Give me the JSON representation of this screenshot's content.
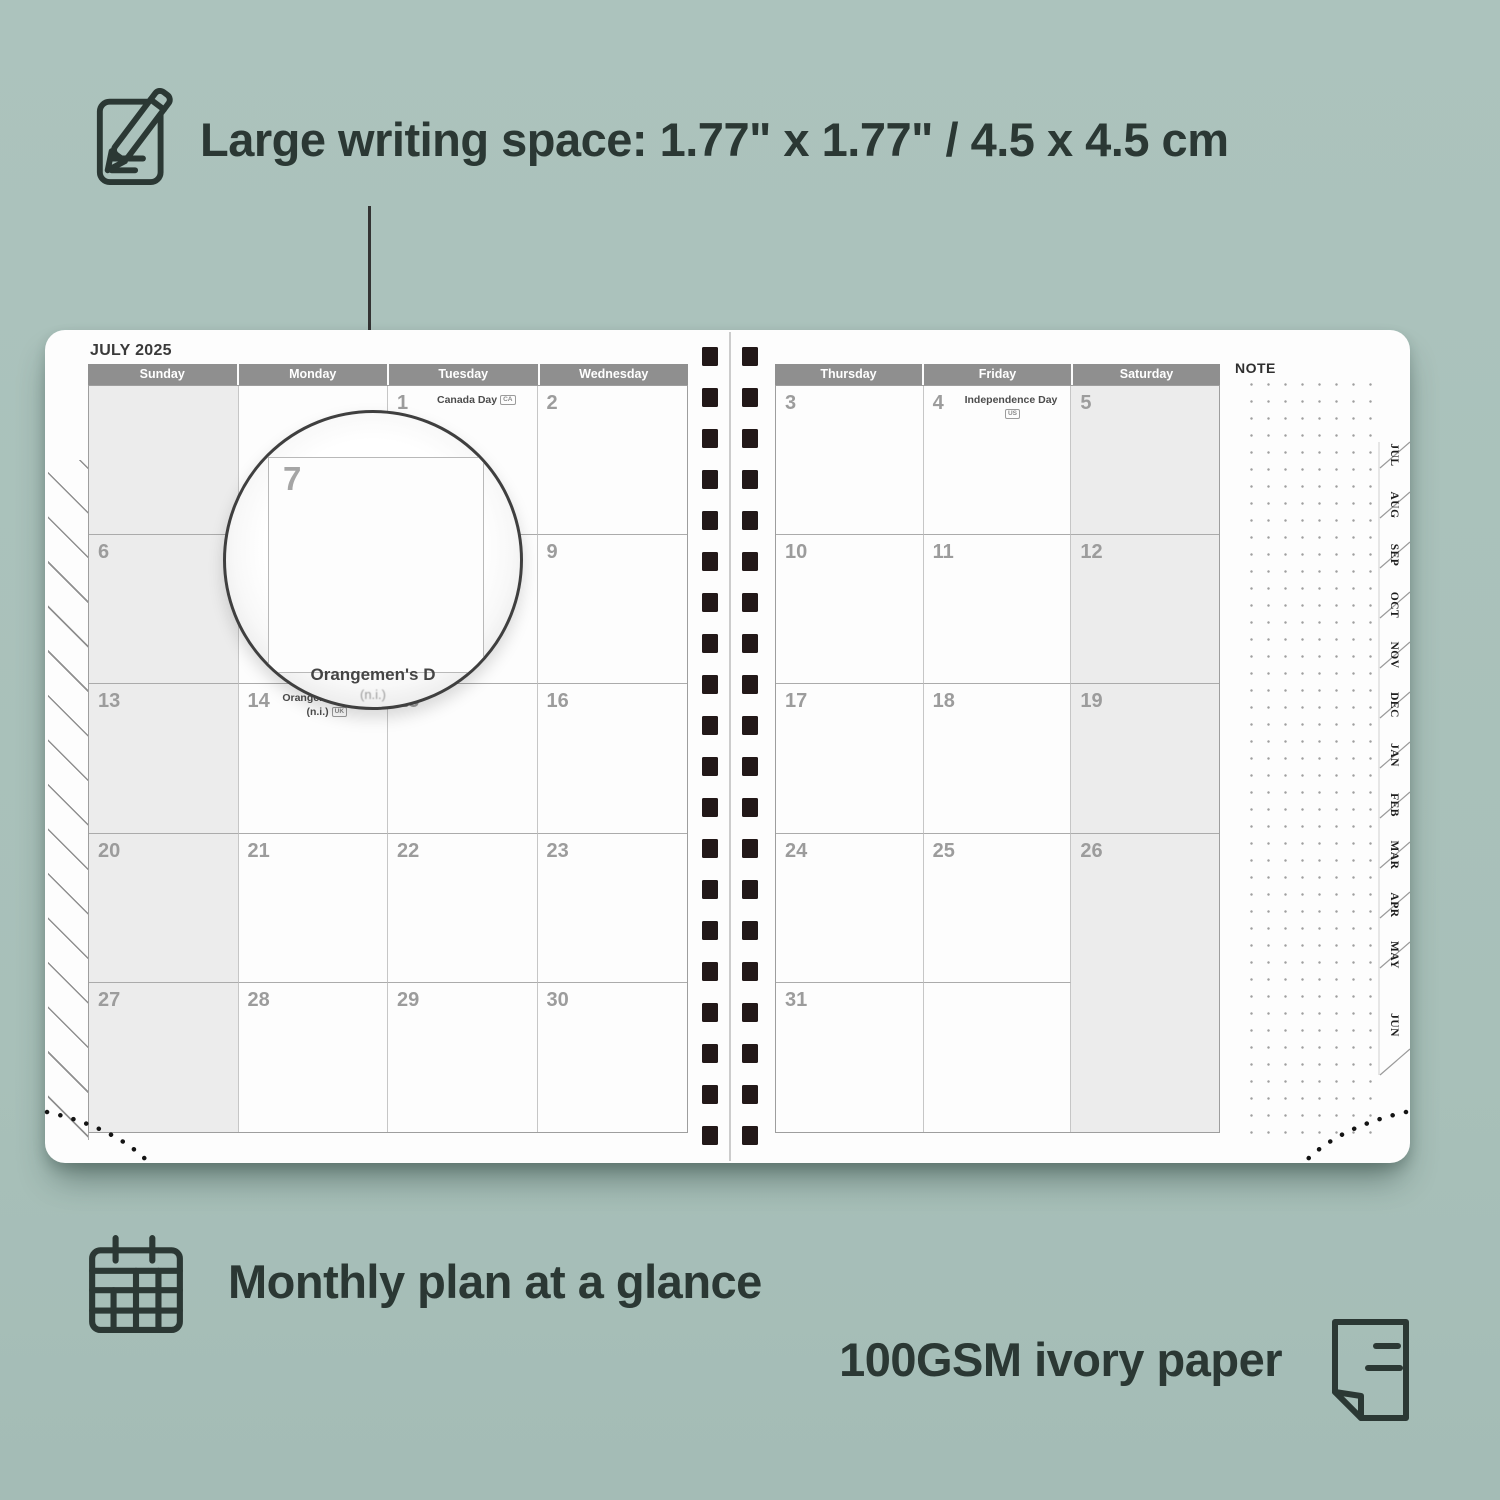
{
  "annotations": {
    "top": {
      "icon": "note-pencil-icon",
      "text": "Large writing space: 1.77\" x 1.77\" / 4.5 x 4.5 cm"
    },
    "bottom_left": {
      "icon": "calendar-grid-icon",
      "text": "Monthly plan at a glance"
    },
    "bottom_right": {
      "icon": "paper-sheet-icon",
      "text": "100GSM ivory paper"
    }
  },
  "planner": {
    "month_title": "JULY 2025",
    "note_label": "NOTE",
    "left_page": {
      "day_headers": [
        "Sunday",
        "Monday",
        "Tuesday",
        "Wednesday"
      ],
      "weekend_col": 0,
      "rows": [
        [
          {
            "date": ""
          },
          {
            "date": ""
          },
          {
            "date": "1",
            "holiday": "Canada Day",
            "badge": "CA"
          },
          {
            "date": "2"
          }
        ],
        [
          {
            "date": "6"
          },
          {
            "date": "7"
          },
          {
            "date": "8"
          },
          {
            "date": "9"
          }
        ],
        [
          {
            "date": "13"
          },
          {
            "date": "14",
            "holiday": "Orangemen's Day",
            "holiday2": "(n.i.)",
            "badge": "UK"
          },
          {
            "date": "15"
          },
          {
            "date": "16"
          }
        ],
        [
          {
            "date": "20"
          },
          {
            "date": "21"
          },
          {
            "date": "22"
          },
          {
            "date": "23"
          }
        ],
        [
          {
            "date": "27"
          },
          {
            "date": "28"
          },
          {
            "date": "29"
          },
          {
            "date": "30"
          }
        ]
      ]
    },
    "right_page": {
      "day_headers": [
        "Thursday",
        "Friday",
        "Saturday"
      ],
      "weekend_col": 2,
      "rows": [
        [
          {
            "date": "3"
          },
          {
            "date": "4",
            "holiday": "Independence Day",
            "badge": "US"
          },
          {
            "date": "5"
          }
        ],
        [
          {
            "date": "10"
          },
          {
            "date": "11"
          },
          {
            "date": "12"
          }
        ],
        [
          {
            "date": "17"
          },
          {
            "date": "18"
          },
          {
            "date": "19"
          }
        ],
        [
          {
            "date": "24"
          },
          {
            "date": "25"
          },
          {
            "date": "26"
          }
        ],
        [
          {
            "date": "31"
          },
          {
            "date": ""
          },
          {
            "date": ""
          }
        ]
      ]
    },
    "magnifier": {
      "day": "7",
      "caption": "Orangemen's D",
      "caption_sub": "(n.i.)"
    },
    "month_tabs": [
      "JUL",
      "AUG",
      "SEP",
      "OCT",
      "NOV",
      "DEC",
      "JAN",
      "FEB",
      "MAR",
      "APR",
      "MAY",
      "JUN"
    ],
    "colors": {
      "background": "#aac1bb",
      "annotation_text": "#2b3834",
      "header_bar": "#8f8f8f",
      "weekend_fill": "#ececec",
      "date_text": "#9c9c9c",
      "binding_squares": "#221818"
    }
  }
}
